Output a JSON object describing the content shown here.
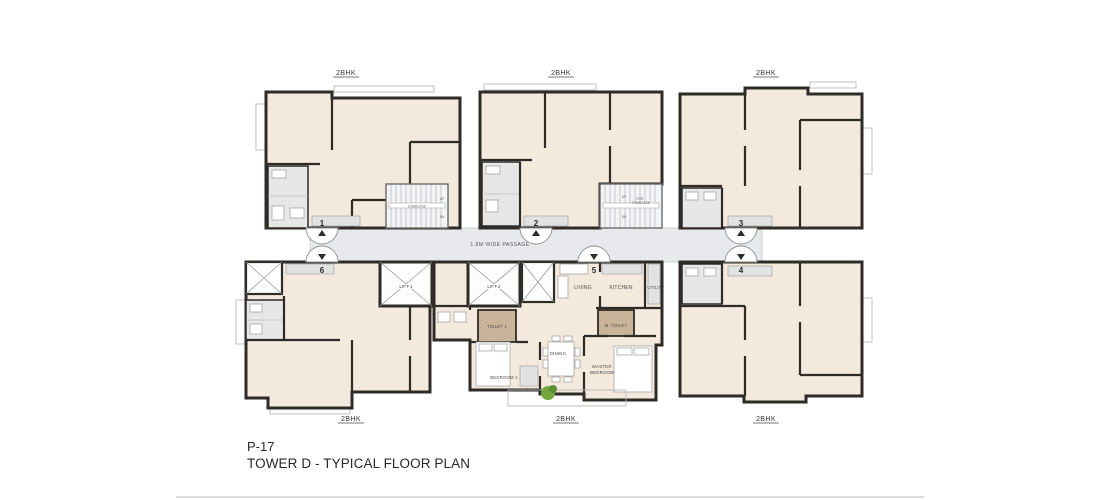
{
  "sheet": {
    "code": "P-17",
    "title": "TOWER D - TYPICAL FLOOR PLAN"
  },
  "labels": {
    "passage": "1.8M WIDE PASSAGE",
    "unit_type": "2BHK",
    "lift1": "LIFT 1",
    "lift2": "LIFT 2",
    "staircase": "STAIRCASE",
    "fire_staircase": "FIRE STAIRCASE",
    "up": "UP",
    "dn": "DN"
  },
  "units": {
    "n1": "1",
    "n2": "2",
    "n3": "3",
    "n4": "4",
    "n5": "5",
    "n6": "6"
  },
  "rooms": {
    "living": "LIVING",
    "kitchen": "KITCHEN",
    "utility": "UTILITY",
    "toilet1": "TOILET 1",
    "m_toilet": "M. TOILET",
    "bedroom1": "BEDROOM 1",
    "dining": "DINING",
    "master_bedroom": "MASTER BEDROOM"
  },
  "colors": {
    "wall": "#2f2b27",
    "unit_fill": "#f3e9dc",
    "passage_fill": "#e8e9ec",
    "wet_fill": "#e7e7e7",
    "tan_fill": "#c9b49a",
    "plant": "#74a83e",
    "text": "#4a4a4a"
  }
}
